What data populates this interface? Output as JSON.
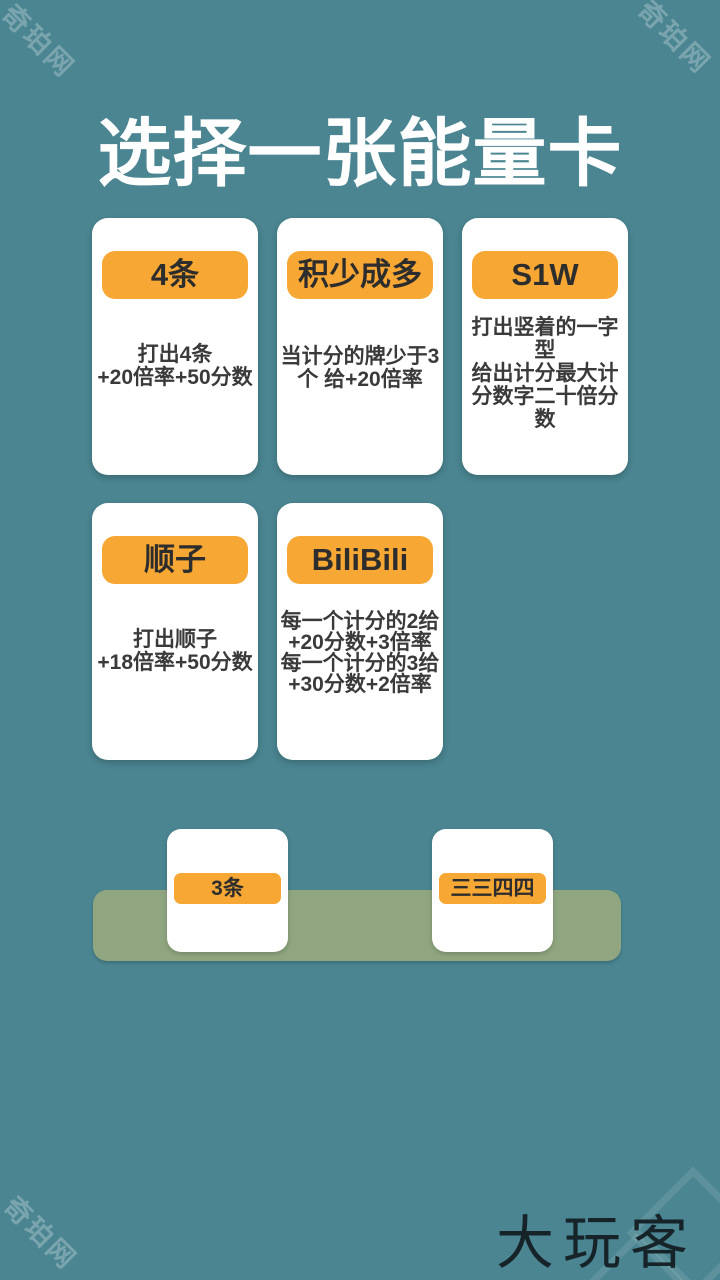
{
  "title": "选择一张能量卡",
  "watermark": {
    "text": "奇珀网"
  },
  "brand": {
    "logo_text": "大玩客"
  },
  "colors": {
    "background": "#4a8591",
    "card": "#ffffff",
    "badge": "#f7a733",
    "badge_text": "#2d2d2d",
    "body_text": "#3a3a3a",
    "tray": "#8fa680",
    "title_text": "#ffffff",
    "logo_text": "#162329"
  },
  "energy_cards": [
    {
      "label": "4条",
      "description": "打出4条\n+20倍率+50分数"
    },
    {
      "label": "积少成多",
      "description": "当计分的牌少于3\n个 给+20倍率"
    },
    {
      "label": "S1W",
      "description": "打出竖着的一字\n型\n给出计分最大计\n分数字二十倍分\n数"
    },
    {
      "label": "顺子",
      "description": "打出顺子\n+18倍率+50分数"
    },
    {
      "label": "BiliBili",
      "description": "每一个计分的2给\n+20分数+3倍率\n每一个计分的3给\n+30分数+2倍率"
    }
  ],
  "hand_cards": [
    {
      "label": "3条"
    },
    {
      "label": "三三四四"
    }
  ]
}
